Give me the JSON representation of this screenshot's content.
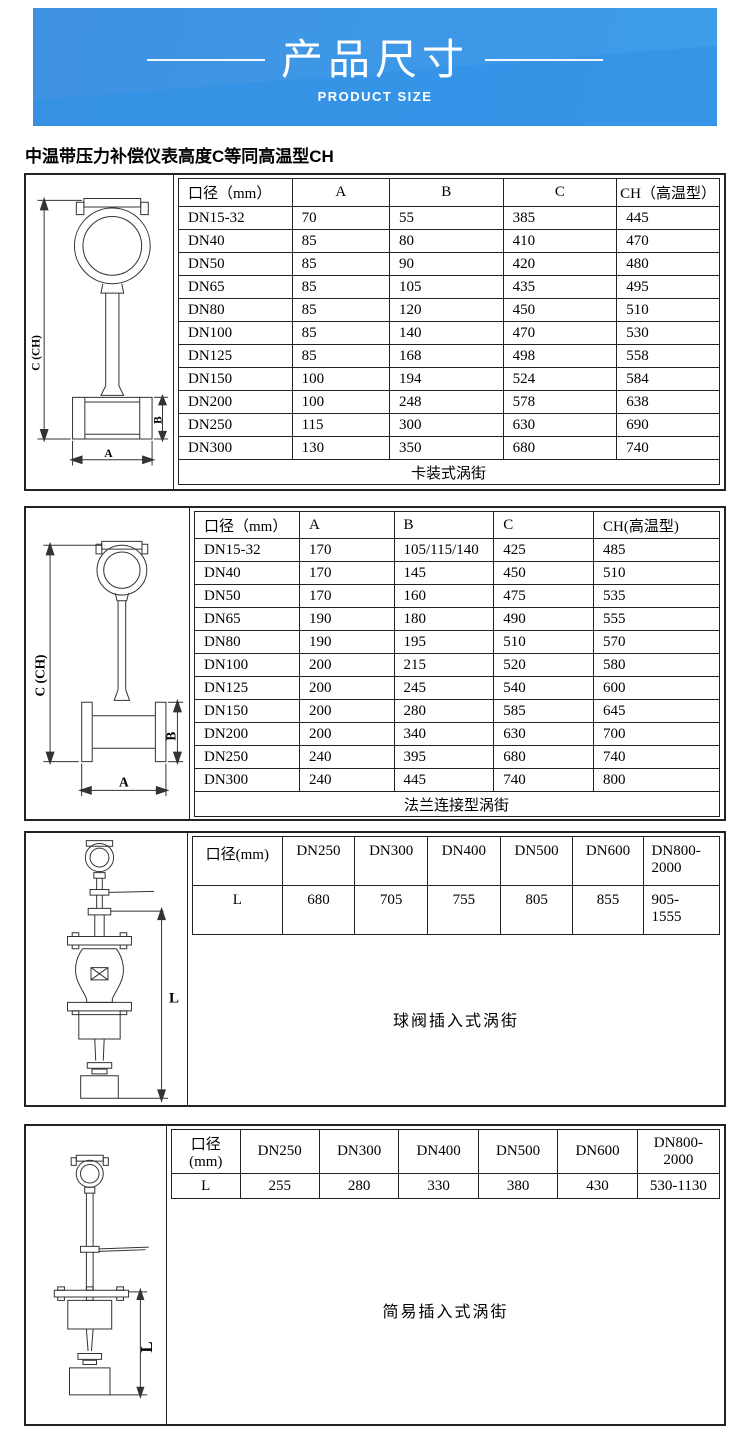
{
  "banner": {
    "title": "产品尺寸",
    "subtitle": "PRODUCT SIZE",
    "colors": {
      "base_blue": "#3d99e8",
      "accent_blue": "#2f8fe6",
      "text": "#ffffff"
    }
  },
  "note": "中温带压力补偿仪表高度C等同高温型CH",
  "sections": [
    {
      "caption": "卡装式涡街",
      "figure": {
        "height_label": "C (CH)",
        "pipe_label": "B",
        "width_label": "A"
      },
      "table": {
        "headers": [
          "口径（mm）",
          "A",
          "B",
          "C",
          "CH（高温型）"
        ],
        "rows": [
          [
            "DN15-32",
            "70",
            "55",
            "385",
            "445"
          ],
          [
            "DN40",
            "85",
            "80",
            "410",
            "470"
          ],
          [
            "DN50",
            "85",
            "90",
            "420",
            "480"
          ],
          [
            "DN65",
            "85",
            "105",
            "435",
            "495"
          ],
          [
            "DN80",
            "85",
            "120",
            "450",
            "510"
          ],
          [
            "DN100",
            "85",
            "140",
            "470",
            "530"
          ],
          [
            "DN125",
            "85",
            "168",
            "498",
            "558"
          ],
          [
            "DN150",
            "100",
            "194",
            "524",
            "584"
          ],
          [
            "DN200",
            "100",
            "248",
            "578",
            "638"
          ],
          [
            "DN250",
            "115",
            "300",
            "630",
            "690"
          ],
          [
            "DN300",
            "130",
            "350",
            "680",
            "740"
          ]
        ],
        "caption_row": "卡装式涡街"
      }
    },
    {
      "caption": "法兰连接型涡街",
      "figure": {
        "height_label": "C (CH)",
        "pipe_label": "B",
        "width_label": "A"
      },
      "table": {
        "headers": [
          "口径（mm）",
          "A",
          "B",
          "C",
          "CH(高温型)"
        ],
        "rows": [
          [
            "DN15-32",
            "170",
            "105/115/140",
            "425",
            "485"
          ],
          [
            "DN40",
            "170",
            "145",
            "450",
            "510"
          ],
          [
            "DN50",
            "170",
            "160",
            "475",
            "535"
          ],
          [
            "DN65",
            "190",
            "180",
            "490",
            "555"
          ],
          [
            "DN80",
            "190",
            "195",
            "510",
            "570"
          ],
          [
            "DN100",
            "200",
            "215",
            "520",
            "580"
          ],
          [
            "DN125",
            "200",
            "245",
            "540",
            "600"
          ],
          [
            "DN150",
            "200",
            "280",
            "585",
            "645"
          ],
          [
            "DN200",
            "200",
            "340",
            "630",
            "700"
          ],
          [
            "DN250",
            "240",
            "395",
            "680",
            "740"
          ],
          [
            "DN300",
            "240",
            "445",
            "740",
            "800"
          ]
        ],
        "caption_row": "法兰连接型涡街"
      }
    },
    {
      "caption": "球阀插入式涡街",
      "figure": {
        "height_label": "L"
      },
      "table": {
        "headers": [
          "口径(mm)",
          "DN250",
          "DN300",
          "DN400",
          "DN500",
          "DN600",
          "DN800-\n2000"
        ],
        "rows": [
          [
            "L",
            "680",
            "705",
            "755",
            "805",
            "855",
            "905-\n1555"
          ]
        ]
      }
    },
    {
      "caption": "简易插入式涡街",
      "figure": {
        "height_label": "L"
      },
      "table": {
        "headers": [
          "口径\n(mm)",
          "DN250",
          "DN300",
          "DN400",
          "DN500",
          "DN600",
          "DN800-\n2000"
        ],
        "rows": [
          [
            "L",
            "255",
            "280",
            "330",
            "380",
            "430",
            "530-1130"
          ]
        ]
      }
    }
  ]
}
